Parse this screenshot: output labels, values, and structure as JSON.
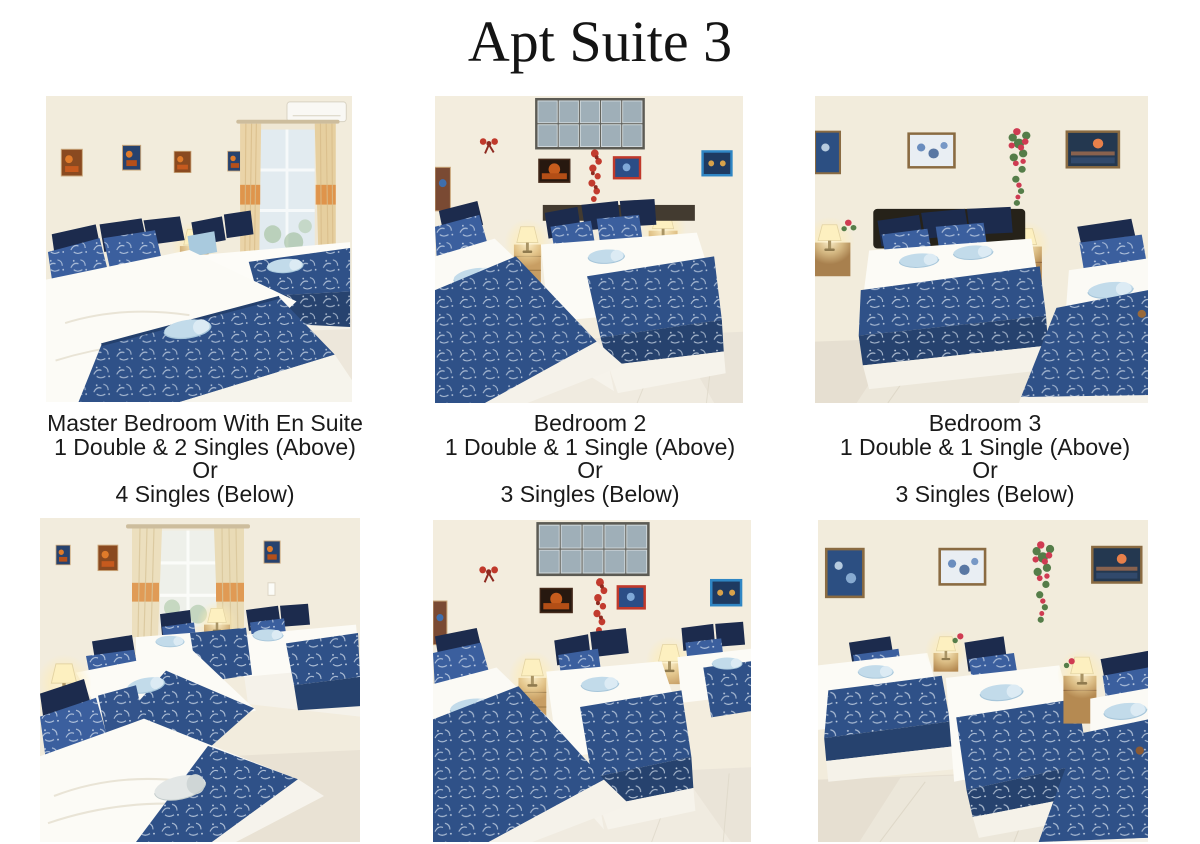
{
  "title": "Apt Suite 3",
  "captions": [
    {
      "lines": [
        "Master Bedroom With En Suite",
        "1 Double & 2 Singles (Above)",
        "Or",
        "4 Singles (Below)"
      ]
    },
    {
      "lines": [
        "Bedroom 2",
        "1 Double & 1 Single (Above)",
        "Or",
        "3 Singles (Below)"
      ]
    },
    {
      "lines": [
        "Bedroom 3",
        "1 Double & 1 Single (Above)",
        "Or",
        "3 Singles (Below)"
      ]
    }
  ],
  "palette": {
    "background": "#ffffff",
    "text": "#1a1a1a",
    "wall_cream": "#f2ecdc",
    "floor": "#e7e0d2",
    "bedspread_blue": "#2f5188",
    "pillow_navy": "#1c2b4d",
    "pillow_blue": "#3b5f9e",
    "towel_blue": "#c2dbea",
    "curtain_tan": "#ead4a8",
    "curtain_orange": "#dd8a3c",
    "garland_red": "#c23b2e",
    "lamp_glow": "#fff3cd",
    "wood": "#b58a52"
  }
}
